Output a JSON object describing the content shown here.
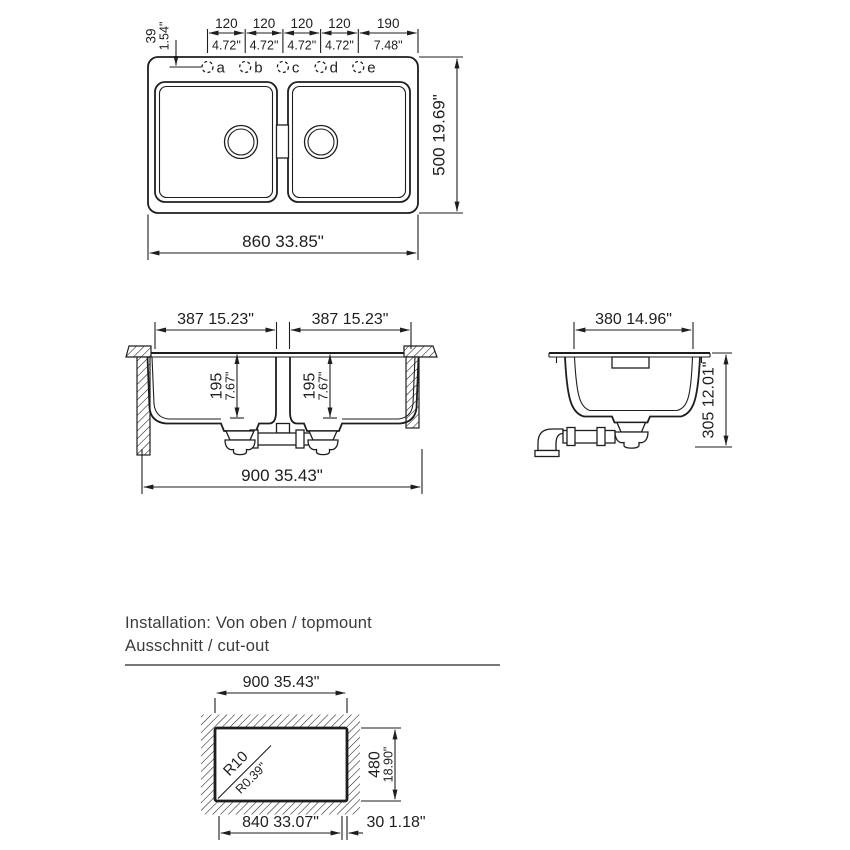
{
  "colors": {
    "line": "#1e1e1e",
    "body_text": "#3b3b3b",
    "background": "#ffffff"
  },
  "top_view": {
    "hole_offset_mm": "39",
    "hole_offset_in": "1.54\"",
    "spacing_mm": [
      "120",
      "120",
      "120",
      "120",
      "190"
    ],
    "spacing_in": [
      "4.72\"",
      "4.72\"",
      "4.72\"",
      "4.72\"",
      "7.48\""
    ],
    "holes": [
      "a",
      "b",
      "c",
      "d",
      "e"
    ],
    "overall_width": "860 33.85\"",
    "overall_depth": "500 19.69\""
  },
  "front_view": {
    "left_bowl_width": "387 15.23\"",
    "right_bowl_width": "387 15.23\"",
    "left_bowl_depth_mm": "195",
    "left_bowl_depth_in": "7.67\"",
    "right_bowl_depth_mm": "195",
    "right_bowl_depth_in": "7.67\"",
    "overall_width": "900 35.43\""
  },
  "side_view": {
    "bowl_width": "380 14.96\"",
    "overall_height": "305 12.01\""
  },
  "installation": {
    "line1": "Installation: Von oben / topmount",
    "line2": "Ausschnitt / cut-out"
  },
  "cutout": {
    "width": "900 35.43\"",
    "height_mm": "480",
    "height_in": "18.90\"",
    "corner_radius_mm": "R10",
    "corner_radius_in": "R0.39\"",
    "inner_width": "840 33.07\"",
    "edge_offset": "30 1.18\""
  }
}
